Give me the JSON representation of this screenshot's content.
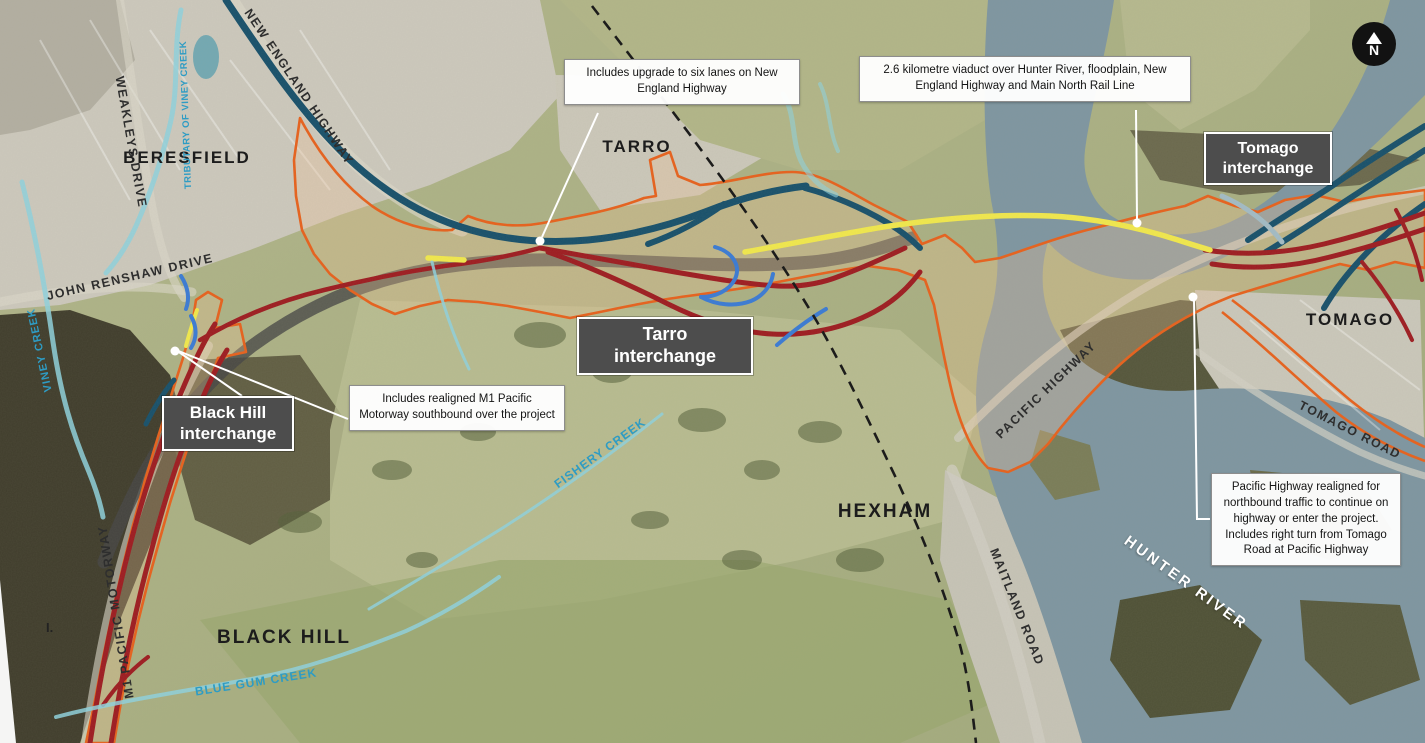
{
  "colors": {
    "boundary_orange": "#e8611c",
    "boundary_fill": "rgba(243,196,150,0.30)",
    "new_road_red": "#9e1b20",
    "existing_road_navy": "#17506b",
    "viaduct_yellow": "#f2e94c",
    "ramp_blue": "#3a7bd5",
    "creek_blue": "#8fd2de",
    "water_gray_blue": "#7e96a1",
    "rail_black": "#151515",
    "badge_gray": "#4d4d4d"
  },
  "north_arrow": {
    "letter": "N"
  },
  "place_labels": [
    {
      "id": "beresfield",
      "text": "BERESFIELD"
    },
    {
      "id": "tarro",
      "text": "TARRO"
    },
    {
      "id": "hexham",
      "text": "HEXHAM"
    },
    {
      "id": "black-hill",
      "text": "BLACK HILL"
    },
    {
      "id": "tomago",
      "text": "TOMAGO"
    }
  ],
  "road_labels": [
    {
      "id": "new-england-highway",
      "text": "NEW ENGLAND HIGHWAY"
    },
    {
      "id": "weakleys-drive",
      "text": "WEAKLEYS DRIVE"
    },
    {
      "id": "john-renshaw-drive",
      "text": "JOHN RENSHAW DRIVE"
    },
    {
      "id": "m1-pacific-motorway",
      "text": "M1 PACIFIC MOTORWAY"
    },
    {
      "id": "pacific-highway",
      "text": "PACIFIC HIGHWAY"
    },
    {
      "id": "maitland-road",
      "text": "MAITLAND ROAD"
    },
    {
      "id": "tomago-road",
      "text": "TOMAGO ROAD"
    }
  ],
  "water_labels": [
    {
      "id": "viney-creek",
      "text": "VINEY CREEK"
    },
    {
      "id": "tributary-of-viney-creek",
      "text": "TRIBUTARY OF VINEY CREEK"
    },
    {
      "id": "fishery-creek",
      "text": "FISHERY CREEK"
    },
    {
      "id": "blue-gum-creek",
      "text": "BLUE GUM CREEK"
    },
    {
      "id": "hunter-river",
      "text": "HUNTER RIVER"
    }
  ],
  "interchange_badges": [
    {
      "name": "Black Hill",
      "line2": "interchange"
    },
    {
      "name": "Tarro",
      "line2": "interchange"
    },
    {
      "name": "Tomago",
      "line2": "interchange"
    }
  ],
  "callouts": [
    {
      "text": "Includes upgrade to six lanes on New England Highway"
    },
    {
      "text": "2.6 kilometre viaduct over Hunter River, floodplain, New England Highway and Main North Rail Line"
    },
    {
      "text": "Includes realigned M1 Pacific Motorway southbound over the project"
    },
    {
      "text": "Pacific Highway realigned for northbound traffic to continue on highway or enter the project. Includes right turn from Tomago Road at Pacific Highway"
    }
  ],
  "edge_text": "I."
}
